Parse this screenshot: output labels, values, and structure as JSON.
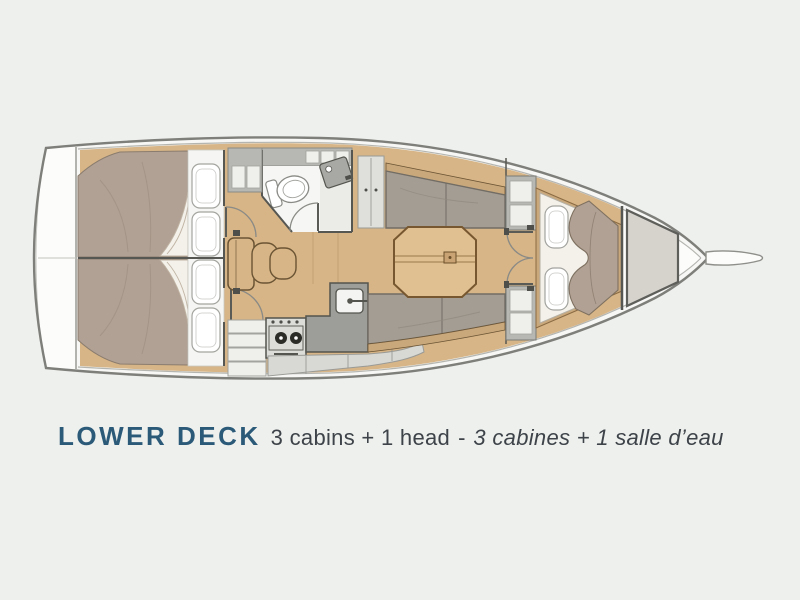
{
  "caption": {
    "title": "LOWER DECK",
    "subtitle_en": "3 cabins + 1 head",
    "separator": "-",
    "subtitle_fr": "3 cabines + 1 salle d’eau"
  },
  "colors": {
    "bg": "#eef0ed",
    "paper_white": "#f7f7f5",
    "platform_white": "#fcfcfb",
    "hull_line": "#7e7e7a",
    "inner_line": "#b4b4b0",
    "bulkhead": "#565652",
    "wall_line": "#8a8a86",
    "wood": "#d7b586",
    "wood_trim": "#c9a87c",
    "wood_dark": "#6b5434",
    "plank": "#c3a172",
    "bed": "#b1a194",
    "bed_line": "#8a7c6e",
    "sheet": "#f3f1ea",
    "sheet_line": "#c0b3a3",
    "pillow": "#f5f5f3",
    "pillow_line": "#a3a39f",
    "settee": "#a49d93",
    "settee_line": "#716c64",
    "table": "#e0c091",
    "table_line": "#77572f",
    "counter": "#9d9d99",
    "counter_dark": "#55554f",
    "steel": "#dcdcd8",
    "burner": "#2b2b27",
    "locker_gray": "#b7b7b3",
    "locker_light": "#dfdfdb",
    "drawer_white": "#efefeb",
    "bath_floor": "#f6f6f4",
    "shower": "#e9e9e5",
    "forepeak": "#d6d3cd",
    "forepeak_line": "#5e5e5a",
    "stowage": "#d8d8d4",
    "hardware": "#4e4e4a",
    "title_color": "#2b5a79",
    "text_color": "#3d4349"
  }
}
